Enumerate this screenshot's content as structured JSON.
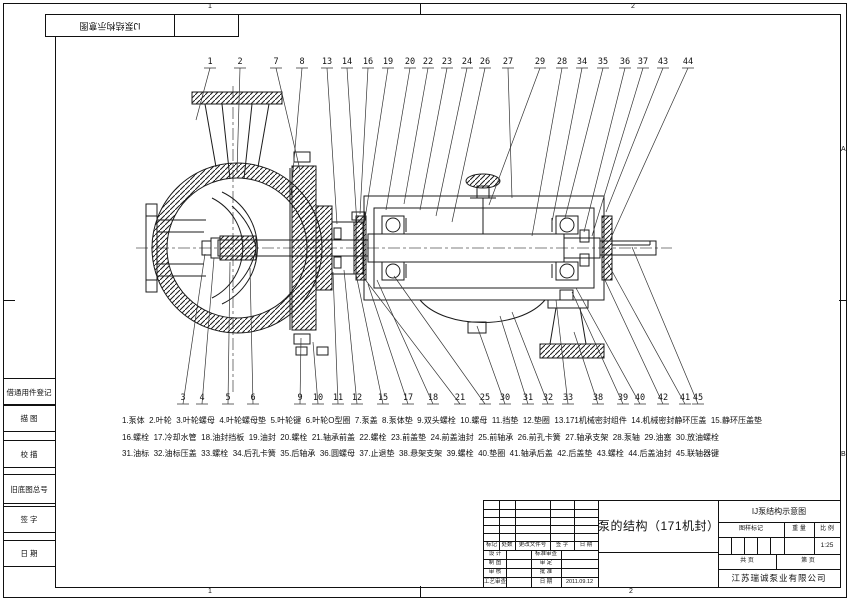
{
  "sheet": {
    "zones": {
      "top_left": "1",
      "top_right": "2",
      "bottom_left": "1",
      "bottom_right": "2",
      "right_upper": "A",
      "right_lower": "B"
    },
    "stamp_title": "IJ泵结构示意图",
    "margin_blocks": [
      "借通用件登记",
      "描  图",
      "校  描",
      "旧底图总号",
      "签  字",
      "日  期"
    ]
  },
  "drawing": {
    "callouts_top": [
      {
        "n": "1",
        "x": 210,
        "tx": 196,
        "ty": 120
      },
      {
        "n": "2",
        "x": 240,
        "tx": 237,
        "ty": 172
      },
      {
        "n": "7",
        "x": 276,
        "tx": 300,
        "ty": 170
      },
      {
        "n": "8",
        "x": 302,
        "tx": 291,
        "ty": 195
      },
      {
        "n": "13",
        "x": 327,
        "tx": 337,
        "ty": 224
      },
      {
        "n": "14",
        "x": 347,
        "tx": 357,
        "ty": 225
      },
      {
        "n": "16",
        "x": 368,
        "tx": 360,
        "ty": 214
      },
      {
        "n": "19",
        "x": 388,
        "tx": 363,
        "ty": 232
      },
      {
        "n": "20",
        "x": 410,
        "tx": 386,
        "ty": 210
      },
      {
        "n": "22",
        "x": 428,
        "tx": 404,
        "ty": 204
      },
      {
        "n": "23",
        "x": 447,
        "tx": 420,
        "ty": 210
      },
      {
        "n": "24",
        "x": 467,
        "tx": 436,
        "ty": 216
      },
      {
        "n": "26",
        "x": 485,
        "tx": 452,
        "ty": 222
      },
      {
        "n": "27",
        "x": 508,
        "tx": 512,
        "ty": 198
      },
      {
        "n": "29",
        "x": 540,
        "tx": 489,
        "ty": 205
      },
      {
        "n": "28",
        "x": 562,
        "tx": 532,
        "ty": 236
      },
      {
        "n": "34",
        "x": 582,
        "tx": 552,
        "ty": 222
      },
      {
        "n": "35",
        "x": 603,
        "tx": 565,
        "ty": 218
      },
      {
        "n": "36",
        "x": 625,
        "tx": 584,
        "ty": 232
      },
      {
        "n": "37",
        "x": 643,
        "tx": 592,
        "ty": 236
      },
      {
        "n": "43",
        "x": 663,
        "tx": 606,
        "ty": 212
      },
      {
        "n": "44",
        "x": 688,
        "tx": 610,
        "ty": 240
      }
    ],
    "callouts_bottom": [
      {
        "n": "3",
        "x": 183,
        "tx": 205,
        "ty": 254
      },
      {
        "n": "4",
        "x": 202,
        "tx": 214,
        "ty": 258
      },
      {
        "n": "5",
        "x": 228,
        "tx": 230,
        "ty": 262
      },
      {
        "n": "6",
        "x": 253,
        "tx": 250,
        "ty": 268
      },
      {
        "n": "9",
        "x": 300,
        "tx": 301,
        "ty": 338
      },
      {
        "n": "10",
        "x": 318,
        "tx": 313,
        "ty": 342
      },
      {
        "n": "11",
        "x": 338,
        "tx": 333,
        "ty": 272
      },
      {
        "n": "12",
        "x": 357,
        "tx": 344,
        "ty": 270
      },
      {
        "n": "15",
        "x": 383,
        "tx": 356,
        "ty": 274
      },
      {
        "n": "17",
        "x": 408,
        "tx": 368,
        "ty": 284
      },
      {
        "n": "18",
        "x": 433,
        "tx": 377,
        "ty": 280
      },
      {
        "n": "21",
        "x": 460,
        "tx": 364,
        "ty": 278
      },
      {
        "n": "25",
        "x": 485,
        "tx": 394,
        "ty": 276
      },
      {
        "n": "30",
        "x": 505,
        "tx": 477,
        "ty": 326
      },
      {
        "n": "31",
        "x": 528,
        "tx": 500,
        "ty": 316
      },
      {
        "n": "32",
        "x": 548,
        "tx": 512,
        "ty": 312
      },
      {
        "n": "33",
        "x": 568,
        "tx": 556,
        "ty": 300
      },
      {
        "n": "38",
        "x": 598,
        "tx": 574,
        "ty": 332
      },
      {
        "n": "39",
        "x": 623,
        "tx": 572,
        "ty": 292
      },
      {
        "n": "40",
        "x": 640,
        "tx": 576,
        "ty": 288
      },
      {
        "n": "42",
        "x": 663,
        "tx": 604,
        "ty": 278
      },
      {
        "n": "41",
        "x": 685,
        "tx": 607,
        "ty": 262
      },
      {
        "n": "45",
        "x": 698,
        "tx": 632,
        "ty": 247
      }
    ]
  },
  "parts_list": {
    "rows": [
      [
        {
          "num": "1",
          "name": "泵体"
        },
        {
          "num": "2",
          "name": "叶轮"
        },
        {
          "num": "3",
          "name": "叶轮螺母"
        },
        {
          "num": "4",
          "name": "叶轮螺母垫"
        },
        {
          "num": "5",
          "name": "叶轮键"
        },
        {
          "num": "6",
          "name": "叶轮O型圈"
        },
        {
          "num": "7",
          "name": "泵盖"
        },
        {
          "num": "8",
          "name": "泵体垫"
        },
        {
          "num": "9",
          "name": "双头螺栓"
        },
        {
          "num": "10",
          "name": "螺母"
        },
        {
          "num": "11",
          "name": "挡垫"
        },
        {
          "num": "12",
          "name": "垫圈"
        },
        {
          "num": "13",
          "name": "171机械密封组件"
        },
        {
          "num": "14",
          "name": "机械密封静环压盖"
        },
        {
          "num": "15",
          "name": "静环压盖垫"
        }
      ],
      [
        {
          "num": "16",
          "name": "螺栓"
        },
        {
          "num": "17",
          "name": "冷却水管"
        },
        {
          "num": "18",
          "name": "油封挡板"
        },
        {
          "num": "19",
          "name": "油封"
        },
        {
          "num": "20",
          "name": "螺栓"
        },
        {
          "num": "21",
          "name": "轴承前盖"
        },
        {
          "num": "22",
          "name": "螺栓"
        },
        {
          "num": "23",
          "name": "前盖垫"
        },
        {
          "num": "24",
          "name": "前盖油封"
        },
        {
          "num": "25",
          "name": "前轴承"
        },
        {
          "num": "26",
          "name": "前孔卡簧"
        },
        {
          "num": "27",
          "name": "轴承支架"
        },
        {
          "num": "28",
          "name": "泵轴"
        },
        {
          "num": "29",
          "name": "油塞"
        },
        {
          "num": "30",
          "name": "放油螺栓"
        }
      ],
      [
        {
          "num": "31",
          "name": "油标"
        },
        {
          "num": "32",
          "name": "油标压盖"
        },
        {
          "num": "33",
          "name": "螺栓"
        },
        {
          "num": "34",
          "name": "后孔卡簧"
        },
        {
          "num": "35",
          "name": "后轴承"
        },
        {
          "num": "36",
          "name": "圆螺母"
        },
        {
          "num": "37",
          "name": "止退垫"
        },
        {
          "num": "38",
          "name": "悬架支架"
        },
        {
          "num": "39",
          "name": "螺栓"
        },
        {
          "num": "40",
          "name": "垫圈"
        },
        {
          "num": "41",
          "name": "轴承后盖"
        },
        {
          "num": "42",
          "name": "后盖垫"
        },
        {
          "num": "43",
          "name": "螺栓"
        },
        {
          "num": "44",
          "name": "后盖油封"
        },
        {
          "num": "45",
          "name": "联轴器键"
        }
      ]
    ]
  },
  "title_block": {
    "product_title": "泵的结构（171机封）",
    "drawing_name": "IJ泵结构示意图",
    "company": "江苏瑞诚泵业有限公司",
    "scale_value": "1:25",
    "date_value": "2011.09.12",
    "labels": {
      "mark": "标记",
      "qty": "处数",
      "change_doc": "更改文件号",
      "signature": "签 字",
      "date": "日 期",
      "design": "设 计",
      "draft": "制 图",
      "review": "审 核",
      "process_review": "工艺审查",
      "std_review": "标准审查",
      "approve": "审 定",
      "ratify": "批 准",
      "date2": "日 期",
      "pattern_mark": "图样标记",
      "weight": "重 量",
      "scale": "比 例",
      "total_pages": "共  页",
      "page_no": "第  页"
    }
  }
}
